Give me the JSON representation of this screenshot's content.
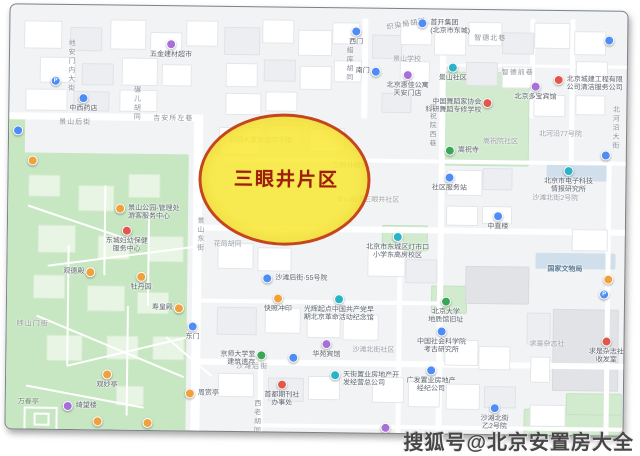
{
  "overlay": {
    "label": "三眼井片区",
    "fill": "#f8e834",
    "stroke": "#c5451e",
    "text_color": "#9e1e0a"
  },
  "watermark": {
    "text": "搜狐号@北京安置房大全"
  },
  "map": {
    "colors": {
      "background": "#f2f3f5",
      "park": "#c7e6c2",
      "road": "#ffffff",
      "marker_blue": "#4e8df6",
      "marker_teal": "#27b3c8",
      "marker_orange": "#f0a13c",
      "marker_red": "#e2574c",
      "marker_purple": "#a770d8",
      "marker_green": "#3aa757"
    },
    "streets": [
      {
        "t": "地安门内大街",
        "x": 56,
        "y": 34,
        "v": 1
      },
      {
        "t": "碾儿胡同",
        "x": 122,
        "y": 80,
        "v": 1
      },
      {
        "t": "景山后街",
        "x": 50,
        "y": 112
      },
      {
        "t": "吉安所左巷",
        "x": 144,
        "y": 107
      },
      {
        "t": "织染局胡同",
        "x": 376,
        "y": 10,
        "r": -10
      },
      {
        "t": "蜡库胡同",
        "x": 334,
        "y": 38,
        "v": 1
      },
      {
        "t": "智德北巷",
        "x": 464,
        "y": 23
      },
      {
        "t": "智德前巷",
        "x": 492,
        "y": 57
      },
      {
        "t": "嵩祝院西巷",
        "x": 418,
        "y": 94,
        "v": 1
      },
      {
        "t": "北河沿大街",
        "x": 601,
        "y": 94,
        "v": 1
      },
      {
        "t": "景山东街",
        "x": 187,
        "y": 210,
        "v": 1
      },
      {
        "t": "沙滩后街",
        "x": 230,
        "y": 354
      },
      {
        "t": "陟山门街",
        "x": 10,
        "y": 314
      },
      {
        "t": "西老胡同",
        "x": 246,
        "y": 392,
        "v": 1
      },
      {
        "t": "花局胡同",
        "x": 206,
        "y": 232,
        "cls": "dim"
      },
      {
        "t": "三眼井胡同",
        "x": 324,
        "y": 152,
        "cls": "under"
      },
      {
        "t": "景山学校",
        "x": 383,
        "y": 45,
        "cls": "dim"
      },
      {
        "t": "嵩祝院社区",
        "x": 474,
        "y": 126,
        "cls": "dim"
      },
      {
        "t": "北河沿77号院",
        "x": 530,
        "y": 118,
        "cls": "dim"
      },
      {
        "t": "沙滩北街2号院",
        "x": 524,
        "y": 182,
        "cls": "dim"
      },
      {
        "t": "国家文物局",
        "x": 540,
        "y": 253,
        "cls": "blue"
      },
      {
        "t": "求是杂志社",
        "x": 523,
        "y": 328,
        "cls": "dim"
      },
      {
        "t": "沙滩北街社区",
        "x": 346,
        "y": 336,
        "cls": "dim"
      },
      {
        "t": "万春亭",
        "x": 12,
        "y": 392,
        "cls": "park"
      },
      {
        "t": "公园大厦饭店写字楼",
        "x": 220,
        "y": 128,
        "cls": "under"
      },
      {
        "t": "景山街道三眼井社区",
        "x": 328,
        "y": 186,
        "cls": "under"
      }
    ],
    "pois": [
      {
        "x": 161,
        "y": 38,
        "c": "purple",
        "t": "五金建材超市",
        "lp": "b"
      },
      {
        "x": 46,
        "y": 76,
        "c": "blue",
        "p": 1
      },
      {
        "x": 74,
        "y": 93,
        "c": "blue",
        "t": "中西药店",
        "lp": "b"
      },
      {
        "x": 9,
        "y": 126,
        "c": "blue"
      },
      {
        "x": 24,
        "y": 156,
        "c": "orange"
      },
      {
        "x": 112,
        "y": 203,
        "c": "orange",
        "t": "景山公园-管理处\n游客服务中心",
        "lp": "r"
      },
      {
        "x": 119,
        "y": 225,
        "c": "red",
        "t": "东城妇幼保健\n服务中心",
        "lp": "b"
      },
      {
        "x": 83,
        "y": 267,
        "c": "orange",
        "t": "观德殿",
        "lp": "l"
      },
      {
        "x": 134,
        "y": 271,
        "c": "orange",
        "t": "牡丹园",
        "lp": "b"
      },
      {
        "x": 172,
        "y": 302,
        "c": "orange",
        "t": "寿皇殿",
        "lp": "l"
      },
      {
        "x": 186,
        "y": 320,
        "c": "blue",
        "t": "东门",
        "lp": "b"
      },
      {
        "x": 101,
        "y": 369,
        "c": "orange",
        "t": "观妙亭",
        "lp": "b"
      },
      {
        "x": 184,
        "y": 387,
        "c": "orange",
        "t": "周赏亭",
        "lp": "r"
      },
      {
        "x": 62,
        "y": 401,
        "c": "purple",
        "t": "绮望楼",
        "lp": "r"
      },
      {
        "x": 92,
        "y": 416,
        "c": "orange"
      },
      {
        "x": 142,
        "y": 417,
        "c": "orange"
      },
      {
        "x": 346,
        "y": 23,
        "c": "blue",
        "t": "西门",
        "lp": "b"
      },
      {
        "x": 412,
        "y": 14,
        "c": "blue",
        "t": "首开集团\n(北京市东城)",
        "lp": "r"
      },
      {
        "x": 366,
        "y": 63,
        "c": "blue",
        "t": "南门",
        "lp": "l"
      },
      {
        "x": 398,
        "y": 66,
        "c": "purple",
        "t": "北京惠佳公寓\n天安门店",
        "lp": "b"
      },
      {
        "x": 443,
        "y": 58,
        "c": "teal",
        "t": "景山社区",
        "lp": "b"
      },
      {
        "x": 478,
        "y": 93,
        "c": "red",
        "t": "中国舞蹈家协会\n科研舞蹈专修学校",
        "lp": "l"
      },
      {
        "x": 441,
        "y": 141,
        "c": "green",
        "t": "嵩祝寺",
        "lp": "r"
      },
      {
        "x": 441,
        "y": 168,
        "c": "blue",
        "t": "社区服务站",
        "lp": "b"
      },
      {
        "x": 526,
        "y": 76,
        "c": "purple",
        "t": "北京多宝宾馆",
        "lp": "b"
      },
      {
        "x": 549,
        "y": 69,
        "c": "red",
        "t": "北京城建工程有限\n公司清洁服务公司",
        "lp": "r"
      },
      {
        "x": 599,
        "y": 29,
        "c": "blue"
      },
      {
        "x": 597,
        "y": 144,
        "c": "blue"
      },
      {
        "x": 560,
        "y": 160,
        "c": "teal",
        "t": "北京市电子科技\n情报研究所",
        "lp": "b"
      },
      {
        "x": 390,
        "y": 228,
        "c": "teal",
        "t": "北京市东城区灯市口\n小学东高房校区",
        "lp": "b"
      },
      {
        "x": 260,
        "y": 271,
        "c": "blue",
        "t": "沙滩后街·55号院",
        "lp": "r"
      },
      {
        "x": 271,
        "y": 291,
        "c": "orange",
        "t": "快照冲印",
        "lp": "b"
      },
      {
        "x": 332,
        "y": 291,
        "c": "teal",
        "t": "光辉起点中国共产党早\n期北京革命活动纪念馆",
        "lp": "b"
      },
      {
        "x": 320,
        "y": 336,
        "c": "purple",
        "t": "华苑宾馆",
        "lp": "b"
      },
      {
        "x": 255,
        "y": 348,
        "c": "green",
        "t": "京师大学堂\n建筑遗存",
        "lp": "l"
      },
      {
        "x": 287,
        "y": 350,
        "c": "blue"
      },
      {
        "x": 439,
        "y": 292,
        "c": "green",
        "t": "北京大学\n地质馆旧址",
        "lp": "b"
      },
      {
        "x": 435,
        "y": 322,
        "c": "blue",
        "t": "中国社会科学院\n考古研究所",
        "lp": "b"
      },
      {
        "x": 490,
        "y": 206,
        "c": "blue",
        "t": "中直楼",
        "lp": "b"
      },
      {
        "x": 489,
        "y": 398,
        "c": "blue",
        "t": "沙滩北街\n乙2号院",
        "lp": "b"
      },
      {
        "x": 600,
        "y": 330,
        "c": "red",
        "t": "求是杂志社\n收发室",
        "lp": "b"
      },
      {
        "x": 425,
        "y": 361,
        "c": "blue",
        "t": "广发置业房地产\n经纪公司",
        "lp": "b"
      },
      {
        "x": 329,
        "y": 367,
        "c": "teal",
        "t": "天街置业房地产开\n发经营总公司",
        "lp": "r"
      },
      {
        "x": 276,
        "y": 377,
        "c": "red",
        "t": "首都期刊社\n办事处",
        "lp": "b"
      },
      {
        "x": 380,
        "y": 419,
        "c": "purple"
      },
      {
        "x": 597,
        "y": 283,
        "c": "blue",
        "p": 1
      },
      {
        "x": 601,
        "y": 268,
        "c": "orange"
      }
    ]
  }
}
